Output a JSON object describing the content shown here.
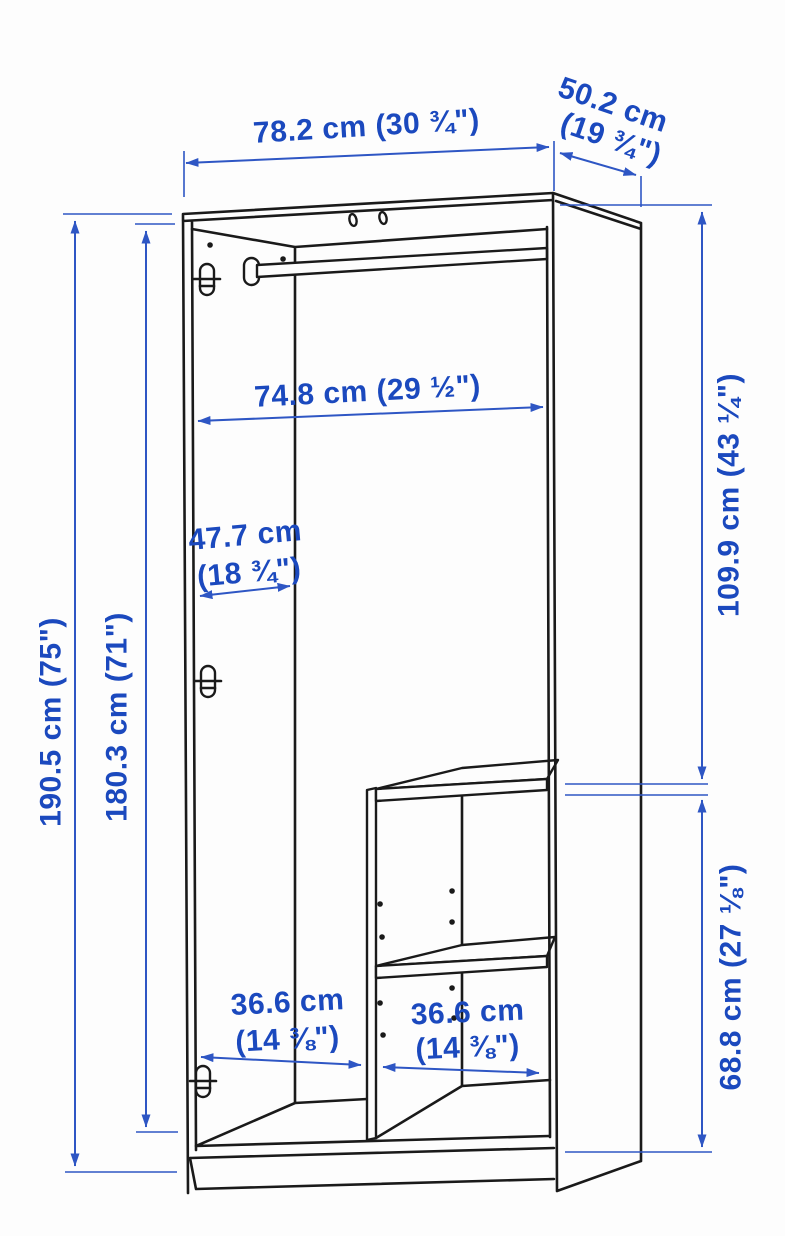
{
  "diagram": {
    "type": "furniture-dimension-diagram",
    "subject": "wardrobe with clothes rail and interior shelf unit",
    "colors": {
      "annotation_text": "#1b49be",
      "annotation_line": "#2e56c4",
      "drawing_line": "#1a1a1a",
      "background": "#fdfdfd"
    },
    "dimensions": {
      "overall_width": {
        "label": "78.2 cm (30 ¾\")"
      },
      "overall_depth": {
        "line1": "50.2 cm",
        "line2": "(19 ¾\")"
      },
      "interior_width": {
        "label": "74.8 cm (29 ½\")"
      },
      "side_panel_depth": {
        "line1": "47.7 cm",
        "line2": "(18 ¾\")"
      },
      "overall_height": {
        "label": "190.5 cm (75\")"
      },
      "interior_height": {
        "label": "180.3 cm (71\")"
      },
      "upper_section_height": {
        "label": "109.9 cm (43 ¼\")"
      },
      "lower_section_height": {
        "label": "68.8 cm (27 ⅛\")"
      },
      "left_compartment_width": {
        "line1": "36.6 cm",
        "line2": "(14 ⅜\")"
      },
      "right_compartment_width": {
        "line1": "36.6 cm",
        "line2": "(14 ⅜\")"
      }
    }
  }
}
